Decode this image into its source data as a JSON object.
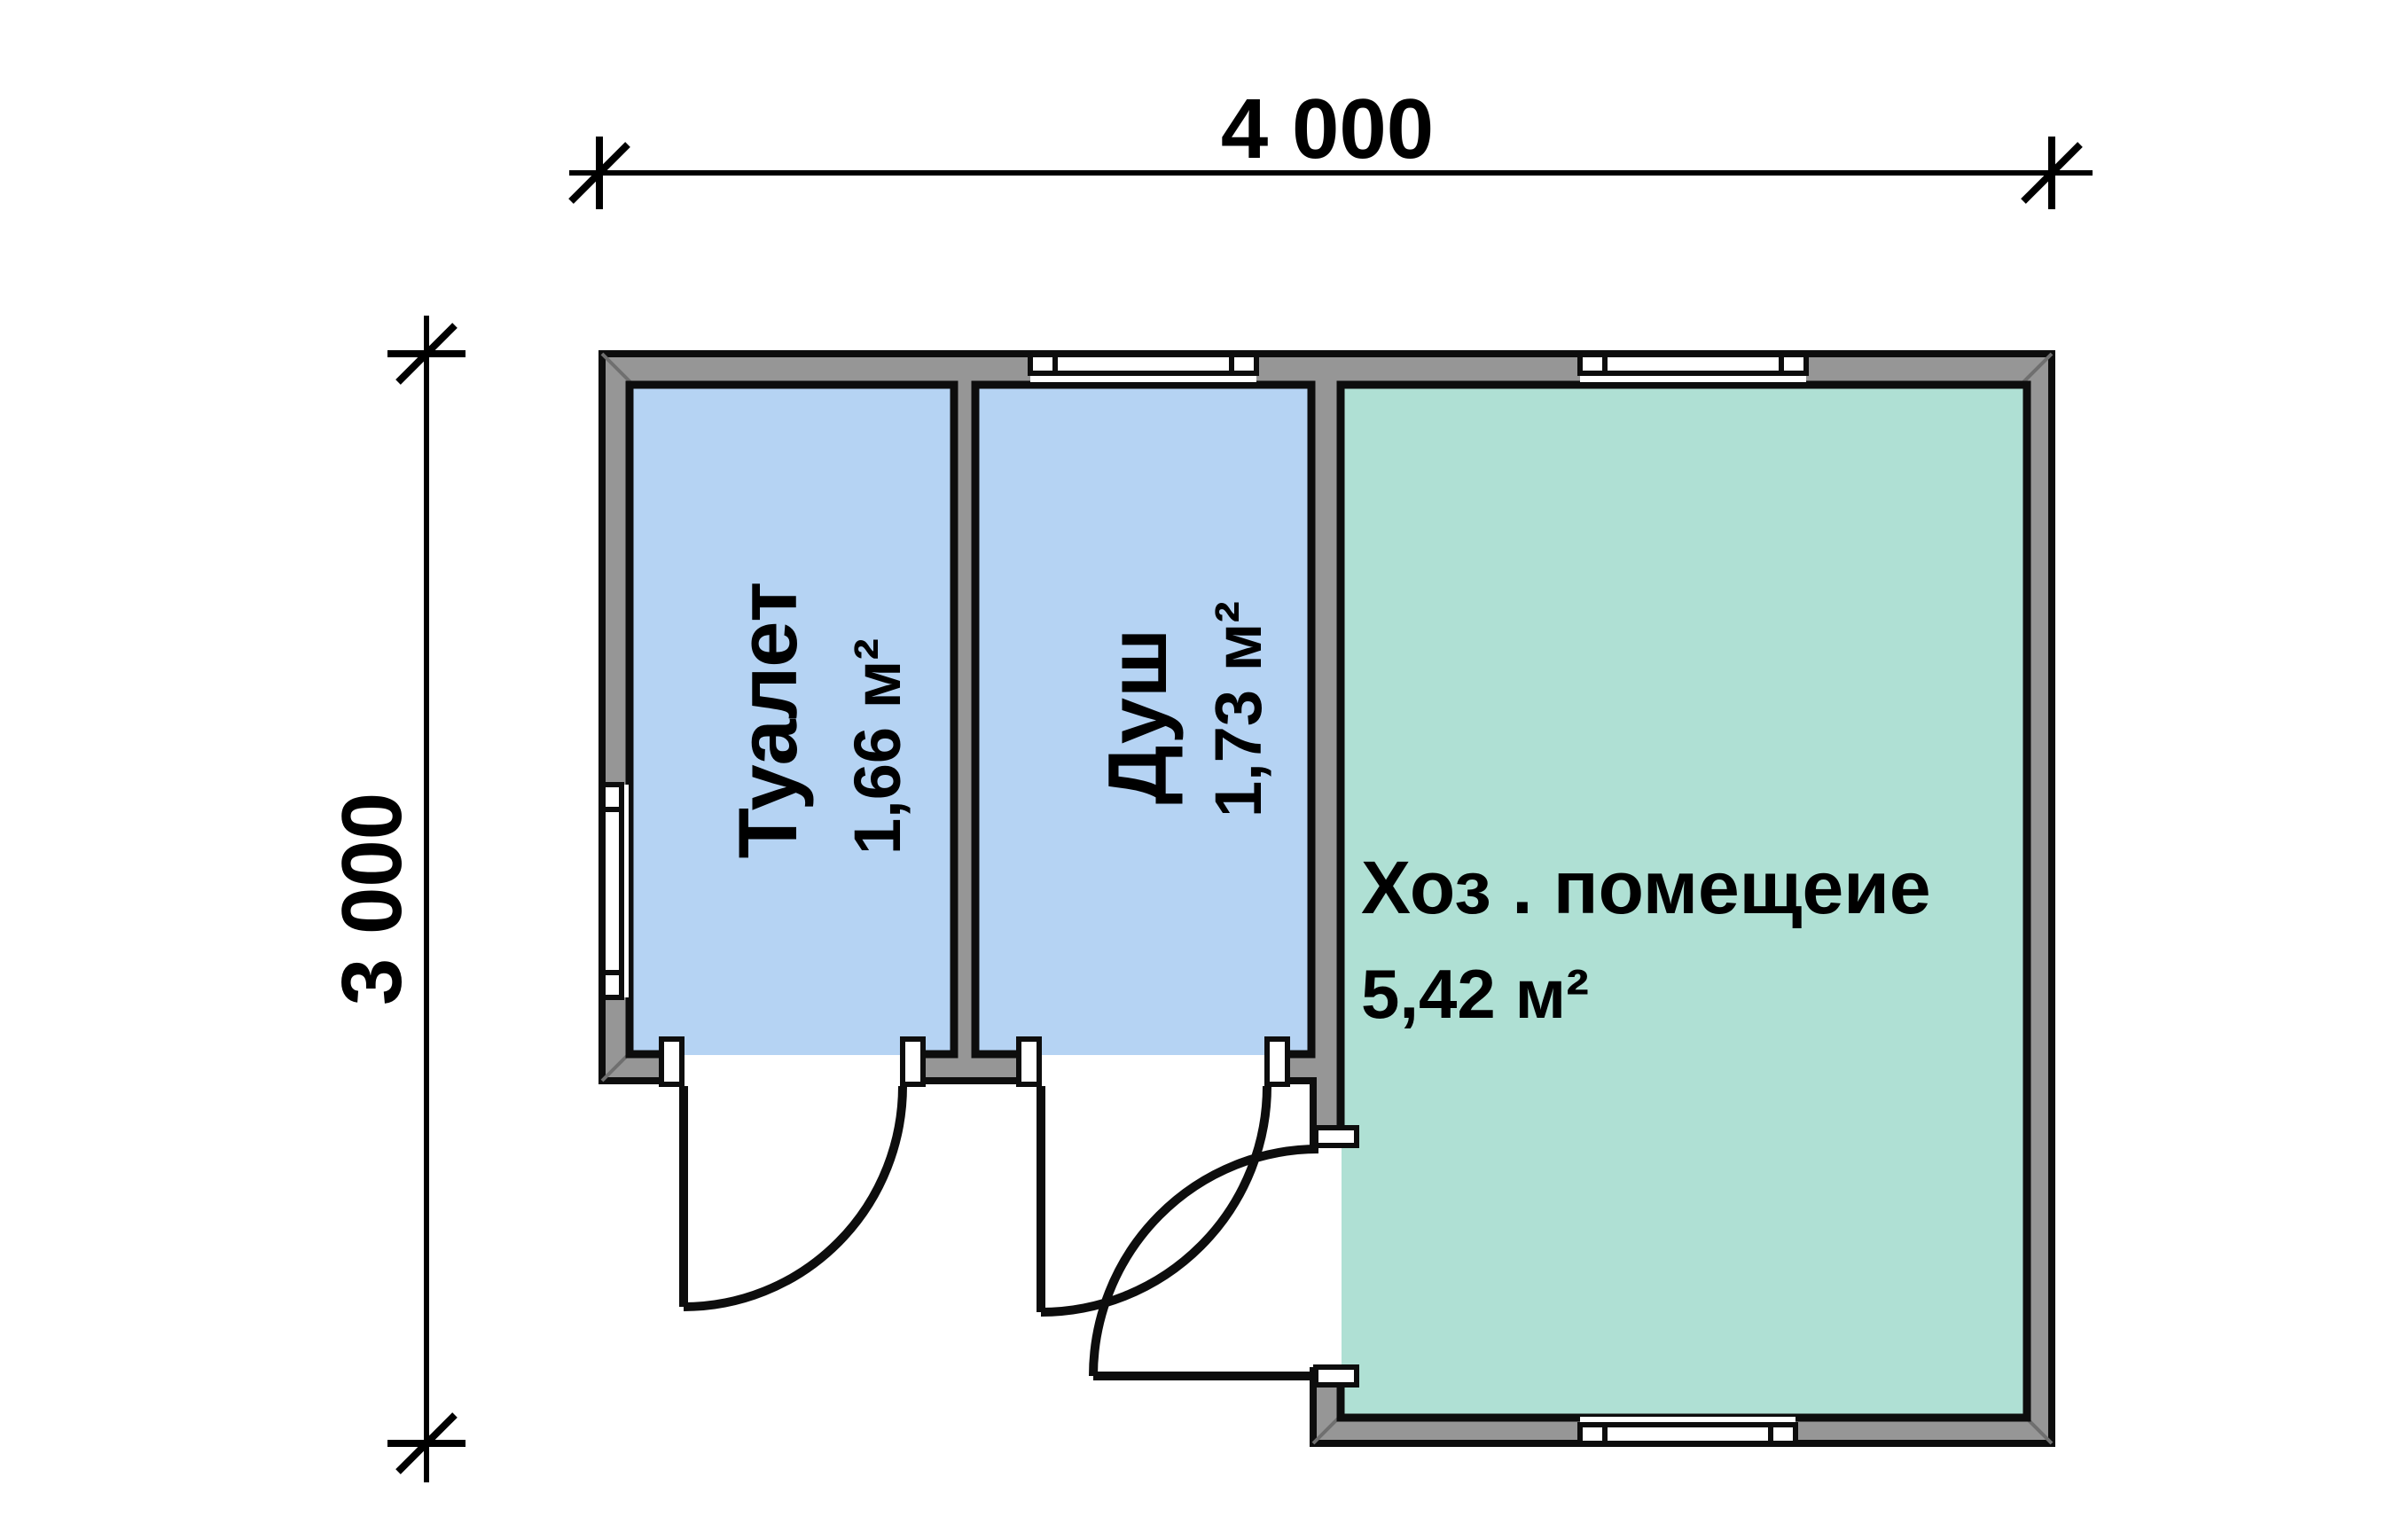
{
  "plan": {
    "dimensions": {
      "top_label": "4 000",
      "left_label": "3 000"
    },
    "rooms": {
      "toilet": {
        "name": "Туалет",
        "area": "1,66 м²",
        "fill": "#b5d3f3"
      },
      "shower": {
        "name": "Душ",
        "area": "1,73 м²",
        "fill": "#b5d3f3"
      },
      "utility": {
        "name": "Хоз . помещеие",
        "area": "5,42 м²",
        "fill": "#afe0d4"
      }
    },
    "colors": {
      "wall_fill": "#969696",
      "outline": "#0d0d0d",
      "background": "#ffffff"
    }
  }
}
